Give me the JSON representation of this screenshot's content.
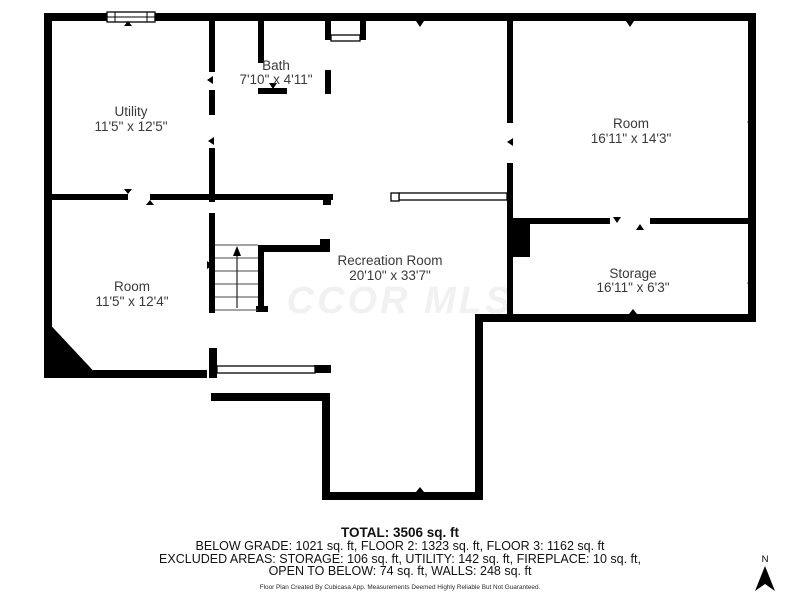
{
  "floor_plan": {
    "rooms": [
      {
        "name": "Utility",
        "dims": "11'5\" x 12'5\""
      },
      {
        "name": "Bath",
        "dims": "7'10\" x 4'11\""
      },
      {
        "name": "Room",
        "dims": "16'11\" x 14'3\""
      },
      {
        "name": "Room",
        "dims": "11'5\" x 12'4\""
      },
      {
        "name": "Recreation Room",
        "dims": "20'10\" x 33'7\""
      },
      {
        "name": "Storage",
        "dims": "16'11\" x 6'3\""
      }
    ],
    "watermark": "CCOR MLS",
    "compass_label": "N"
  },
  "summary": {
    "total": "TOTAL: 3506 sq. ft",
    "line1": "BELOW GRADE: 1021 sq. ft, FLOOR 2: 1323 sq. ft, FLOOR 3: 1162 sq. ft",
    "line2": "EXCLUDED AREAS: STORAGE: 106 sq. ft, UTILITY: 142 sq. ft, FIREPLACE: 10 sq. ft,",
    "line3": "OPEN TO BELOW: 74 sq. ft, WALLS: 248 sq. ft",
    "disclaimer": "Floor Plan Created By Cubicasa App. Measurements Deemed Highly Reliable But Not Guaranteed."
  },
  "colors": {
    "wall": "#000000",
    "label": "#3a3a3a",
    "watermark": "#f1f1f1",
    "background": "#ffffff"
  }
}
